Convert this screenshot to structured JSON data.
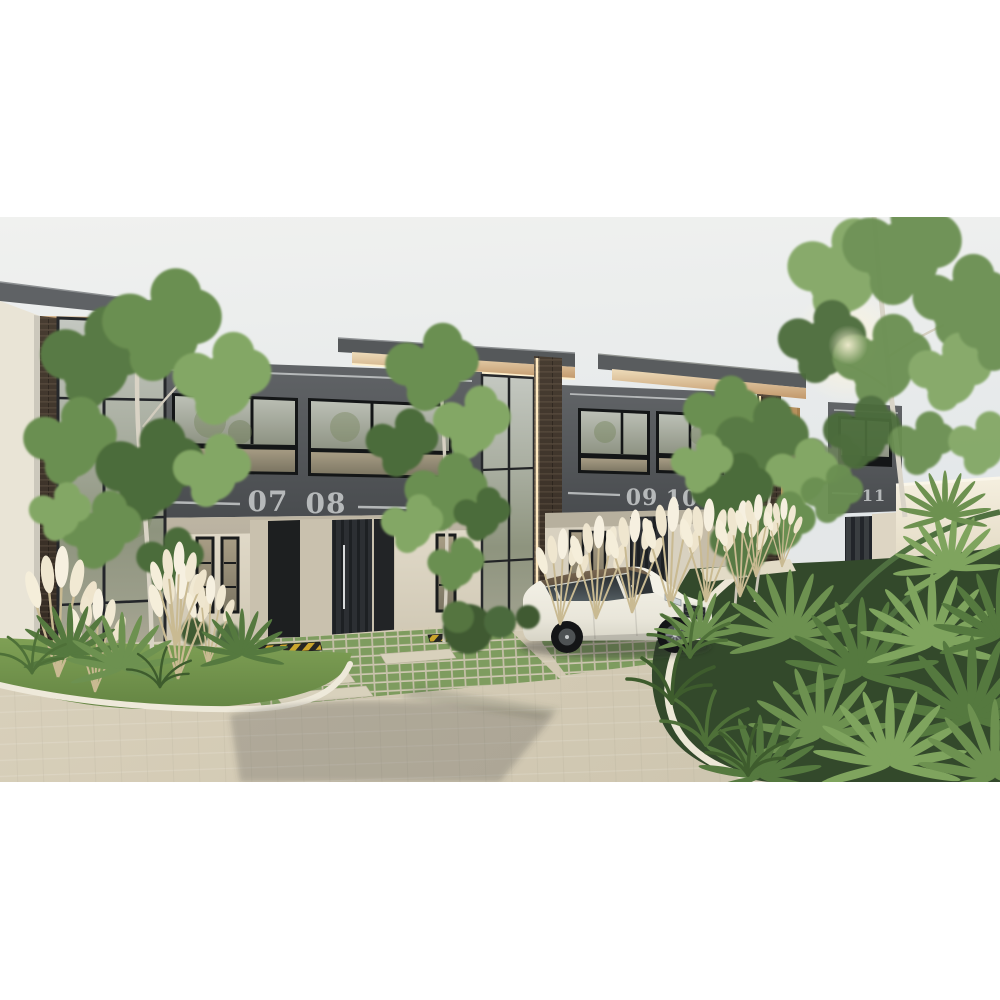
{
  "scene": {
    "type": "3D architectural exterior render",
    "subject": "Row of modern two-story townhouses with numbered units, landscaped driveways and a parked white SUV"
  },
  "units": {
    "u07": "07",
    "u08": "08",
    "u09": "09",
    "u10": "10",
    "u11": "11"
  },
  "palette": {
    "sky": "#e8ebec",
    "facade_dark": "#54575a",
    "facade_beige": "#dcd5c4",
    "wood_fascia": "#c9a071",
    "cream_fascia": "#e9d9b8",
    "brick": "#3e352c",
    "led_strip": "#ffe9bd",
    "number_text": "#b6b9ba",
    "glass": "#9aa091",
    "road_pavers": "#d4ccb7",
    "lawn": "#74954e",
    "foliage": "#5f8048",
    "curb": "#ece7d7",
    "car_body": "#efede3",
    "car_roof": "#6c5a47",
    "hazard_yellow": "#caa52c",
    "hazard_black": "#262624"
  }
}
